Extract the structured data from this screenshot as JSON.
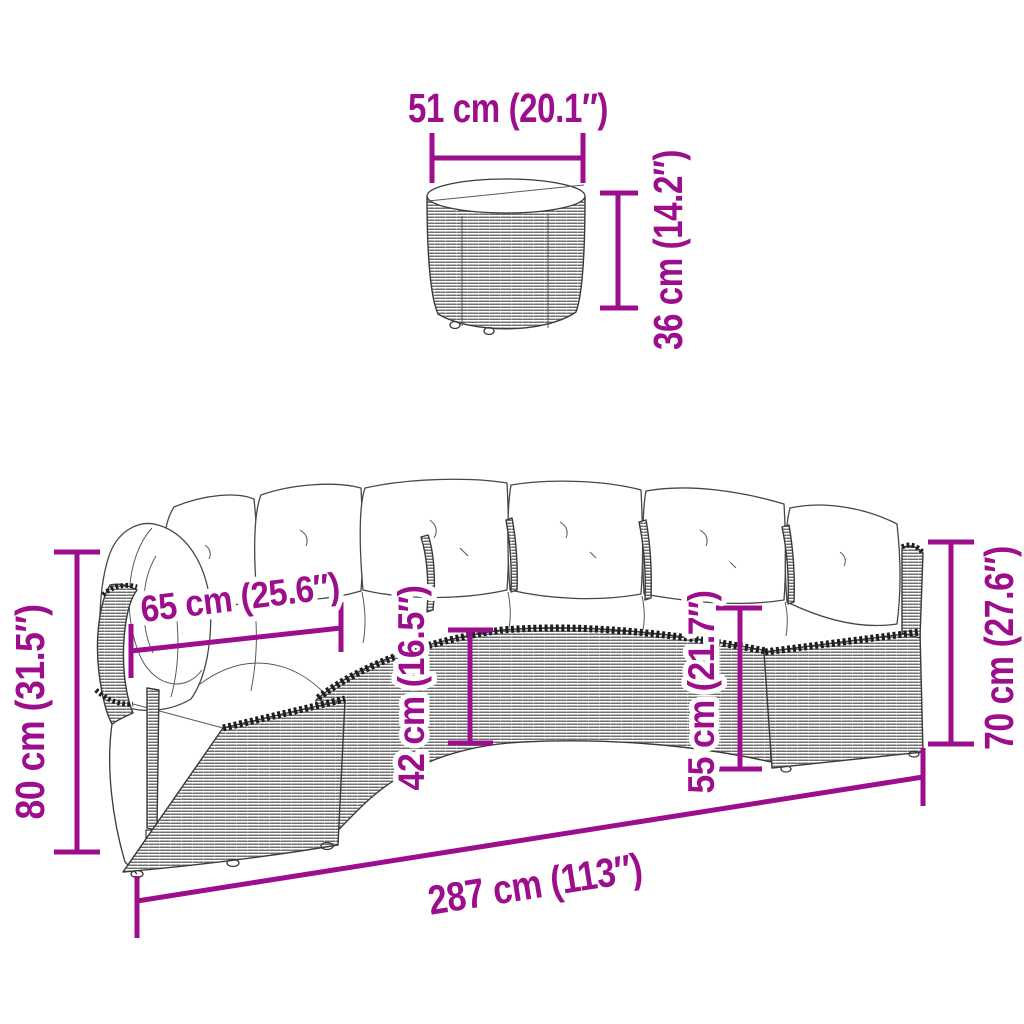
{
  "figure": {
    "type": "product-dimension-diagram",
    "items": [
      "round-rattan-side-table",
      "half-round-rattan-sofa-with-cushions"
    ]
  },
  "colors": {
    "dimension_accent": "#9C0E8C",
    "drawing_outline": "#3A3A3A",
    "background": "#FFFFFF",
    "cushions": "#FFFFFF"
  },
  "labels": {
    "table_width": "51 cm (20.1″)",
    "table_height": "36 cm (14.2″)",
    "sofa_arm_height": "80 cm (31.5″)",
    "sofa_seat_depth": "65 cm (25.6″)",
    "sofa_seat_height": "42 cm (16.5″)",
    "sofa_seat_back_height": "55 cm (21.7″)",
    "sofa_back_height": "70 cm (27.6″)",
    "sofa_total_width": "287 cm (113″)"
  }
}
